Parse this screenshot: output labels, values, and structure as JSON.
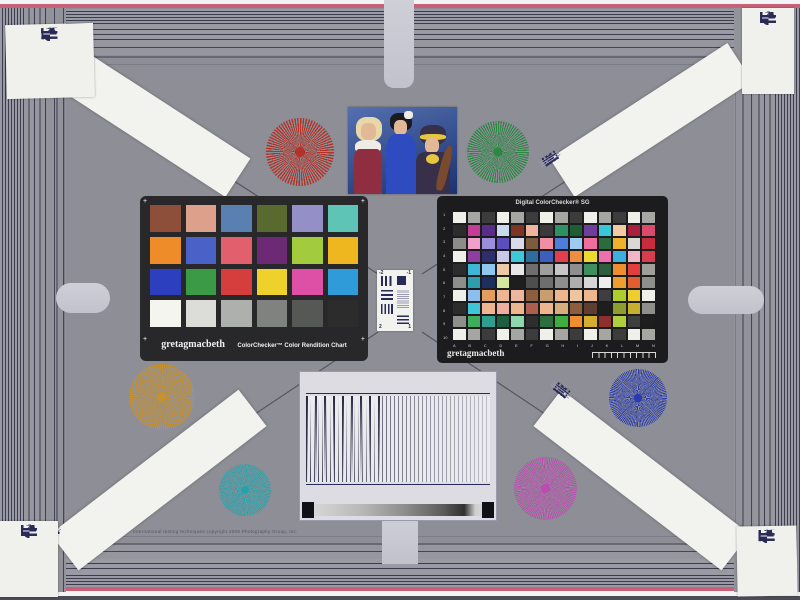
{
  "board": {
    "background": "#8e8e96",
    "frame_color": "#686872",
    "tab_color": "#c9c9d1",
    "stripe_dark": "#3c3c4e",
    "stripe_light": "#9a9aa4",
    "accent_pink": "#c86078"
  },
  "fine_print": "International testing techniques copyright 2008 Photography Group, Inc.",
  "corner_card": {
    "numbers": [
      "-2",
      "-1",
      "1",
      "2"
    ]
  },
  "usaf_center": {
    "numbers": [
      "-2",
      "-1",
      "2",
      "1"
    ]
  },
  "cc24": {
    "brand": "gretagmacbeth",
    "name": "ColorChecker™ Color Rendition Chart",
    "corner_mark": "+",
    "colors": [
      "#8e4f3a",
      "#dda08b",
      "#5a80b2",
      "#586a2e",
      "#958fc8",
      "#5ec4b6",
      "#ee8c2a",
      "#4a61c8",
      "#e2606e",
      "#6b2a73",
      "#a3cb3e",
      "#eeb71f",
      "#2b3fbf",
      "#3b9a46",
      "#d63e3e",
      "#efd12c",
      "#de4fa6",
      "#2f9bd8",
      "#f5f5f0",
      "#dcdcd8",
      "#aeb0ae",
      "#808280",
      "#565856",
      "#2c2c2c"
    ]
  },
  "sg": {
    "title": "Digital ColorChecker® SG",
    "brand": "gretagmacbeth",
    "row_labels": [
      "1",
      "2",
      "3",
      "4",
      "5",
      "6",
      "7",
      "8",
      "9",
      "10"
    ],
    "col_labels": [
      "A",
      "B",
      "C",
      "D",
      "E",
      "F",
      "G",
      "H",
      "I",
      "J",
      "K",
      "L",
      "M",
      "N"
    ],
    "colors": [
      [
        "#f0f0ea",
        "#a6a6a2",
        "#3c3c3c",
        "#f0f0ea",
        "#a6a6a2",
        "#3c3c3c",
        "#f0f0ea",
        "#a6a6a2",
        "#3c3c3c",
        "#f0f0ea",
        "#a6a6a2",
        "#3c3c3c",
        "#f0f0ea",
        "#a6a6a2"
      ],
      [
        "#2c2c2c",
        "#c23e92",
        "#5a2c8a",
        "#c8daee",
        "#7e3424",
        "#eeb49e",
        "#3a3a3a",
        "#2c9262",
        "#1e5e36",
        "#6e3e9a",
        "#3ac8d8",
        "#f2caa4",
        "#aa1e3e",
        "#da4a6a"
      ],
      [
        "#8c8c88",
        "#f0a0ca",
        "#9c8eda",
        "#5c4ebc",
        "#dadaea",
        "#7c5c3c",
        "#f08ea4",
        "#4c7eda",
        "#9eccf0",
        "#f06e9e",
        "#2c6c3c",
        "#f0b22c",
        "#dad8d6",
        "#c62c3c"
      ],
      [
        "#f0f0ea",
        "#8e3e9e",
        "#2e2e6e",
        "#c8c8e8",
        "#3ec8d8",
        "#2e6e9e",
        "#3e5ebe",
        "#e23e4e",
        "#ee8e3e",
        "#eeda2e",
        "#ee6eae",
        "#3eaede",
        "#eeb6c6",
        "#d63e4e"
      ],
      [
        "#2c2c2c",
        "#3eb6d8",
        "#8ec8ee",
        "#eec8a8",
        "#e8e8e6",
        "#6e6e6e",
        "#9e9e9e",
        "#c6c6c6",
        "#8e8e8e",
        "#3e8e5e",
        "#2e5e3e",
        "#ee8e2e",
        "#e23e3e",
        "#9e9e9a"
      ],
      [
        "#8e8e8a",
        "#2e9eae",
        "#1e2e5e",
        "#d6e69e",
        "#1e1e1e",
        "#4e4e4e",
        "#6e6e6e",
        "#8e8e8e",
        "#aeaeae",
        "#d6d6d6",
        "#eeeeea",
        "#ee9e2e",
        "#e25e2e",
        "#8e8e8a"
      ],
      [
        "#f0f0ea",
        "#8ebeee",
        "#e29e5e",
        "#eeb68e",
        "#eeb69e",
        "#8e5e3e",
        "#c89e6e",
        "#eeb68e",
        "#eec69e",
        "#eeb68e",
        "#3e3e3e",
        "#aece2e",
        "#eece2e",
        "#f0f0ea"
      ],
      [
        "#2c2c2c",
        "#3ec6d6",
        "#eeb68e",
        "#eeae9e",
        "#eeb68e",
        "#ae5e4e",
        "#eeb68e",
        "#d6ae7e",
        "#8e5e3e",
        "#5e3e2e",
        "#1e1e1e",
        "#8e9e2e",
        "#c6ae2e",
        "#8e8e8a"
      ],
      [
        "#8e8e8a",
        "#3eae5e",
        "#2e9e8e",
        "#1e5e3e",
        "#8ed6ae",
        "#2e2e2e",
        "#2e6e3e",
        "#3eae3e",
        "#ee8e2e",
        "#d6ae2e",
        "#8e2e2e",
        "#aece3e",
        "#3e3e3e",
        "#1e1e1e"
      ],
      [
        "#f0f0ea",
        "#a6a6a2",
        "#3c3c3c",
        "#f0f0ea",
        "#a6a6a2",
        "#3c3c3c",
        "#f0f0ea",
        "#a6a6a2",
        "#3c3c3c",
        "#f0f0ea",
        "#a6a6a2",
        "#3c3c3c",
        "#f0f0ea",
        "#a6a6a2"
      ]
    ]
  },
  "starbursts": {
    "red": "#b23227",
    "green": "#2c8742",
    "gold": "#c6912f",
    "blue": "#2a3cb0",
    "teal": "#23a4ad",
    "magenta": "#bb4cb0"
  },
  "photo": {
    "palette": {
      "bgTop": "#5470b0",
      "bgBottom": "#1c3270",
      "skin": "#e2b896",
      "blonde": "#e8d8a8",
      "redDress": "#8e2e40",
      "white": "#f0ece4",
      "blueDress": "#2e4cc0",
      "blackHair": "#1a1a22",
      "turban": "#38304a",
      "yellow": "#e6c63e",
      "wood": "#7a4a2e"
    }
  }
}
